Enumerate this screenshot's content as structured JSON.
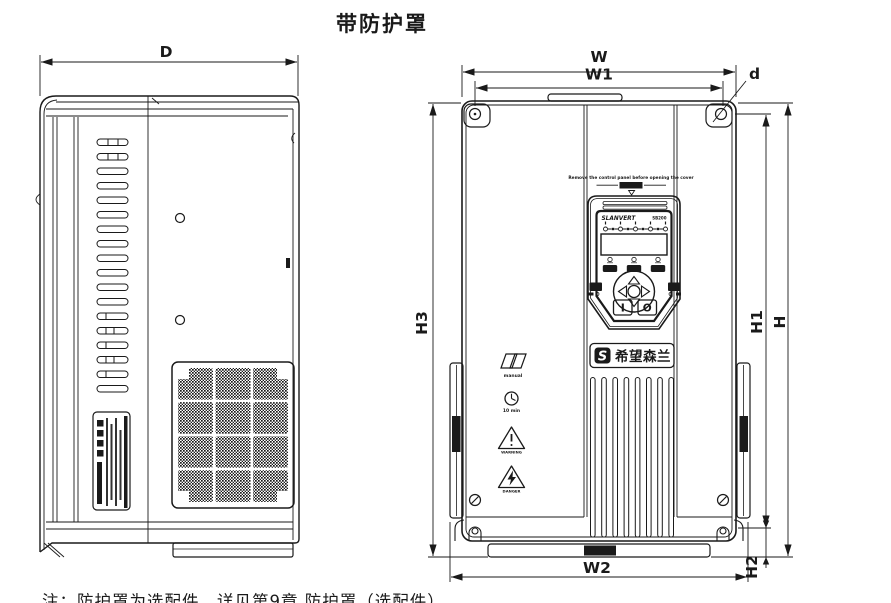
{
  "title": "带防护罩",
  "note": "注：防护罩为选配件，详见第9章 防护罩（选配件）",
  "colors": {
    "line": "#1a1a1a",
    "background": "#ffffff"
  },
  "dimensions": {
    "D": "D",
    "W": "W",
    "W1": "W1",
    "d": "d",
    "H": "H",
    "H1": "H1",
    "H2": "H2",
    "H3": "H3",
    "W2": "W2"
  },
  "front_panel": {
    "cover_warning": "Remove the control panel before opening the cover",
    "keypad": {
      "brand": "SLANVERT",
      "model": "SB200",
      "run_key": "I",
      "stop_key": "O"
    },
    "logo": {
      "symbol": "S",
      "text": "希望森兰"
    },
    "safety_icons": [
      {
        "icon": "manual-icon",
        "label": "manual"
      },
      {
        "icon": "clock-icon",
        "label": "10 min"
      },
      {
        "icon": "warning-icon",
        "label": "WARNING"
      },
      {
        "icon": "danger-icon",
        "label": "DANGER"
      }
    ]
  }
}
